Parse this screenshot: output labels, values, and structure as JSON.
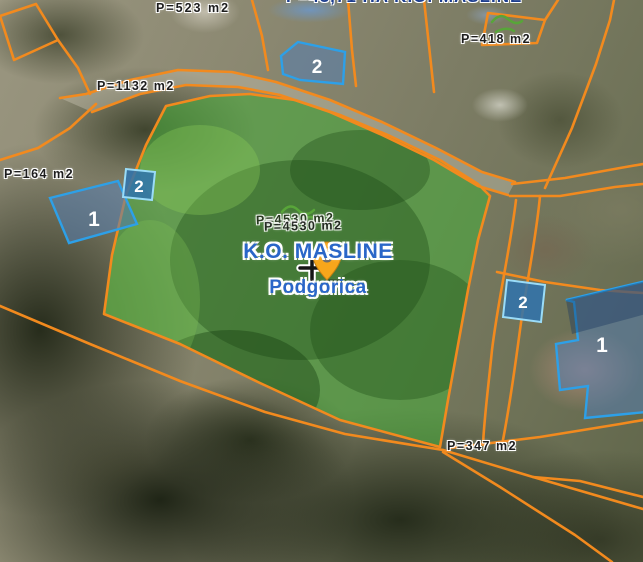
{
  "title": {
    "region": "K.O. MASLINE",
    "city": "Podgorica"
  },
  "area_labels": {
    "top_left": "P=523 m2",
    "top_clipped": "P=43,71 HA  K.O. MASLINE",
    "upper_road": "P=1132 m2",
    "far_left": "P=164 m2",
    "top_right": "P=418 m2",
    "bottom_right": "P=347 m2",
    "selected_parcel": "P=4530 m2",
    "selected_parcel_echo": "P=4530 m2"
  },
  "features": {
    "building_left": {
      "number": "1"
    },
    "annex_badge_left": {
      "number": "2"
    },
    "building_top": {
      "number": "2"
    },
    "annex_badge_right": {
      "number": "2"
    },
    "building_right": {
      "number": "1"
    }
  },
  "colors": {
    "parcel_boundary": "#f28a1e",
    "selected_parcel_fill": "#4aa83c",
    "building_fill": "#567eb0",
    "building_stroke": "#2da0e8",
    "badge_fill": "#2f73ae",
    "label_blue": "#2a66c8",
    "marker_orange": "#f7a61b"
  }
}
